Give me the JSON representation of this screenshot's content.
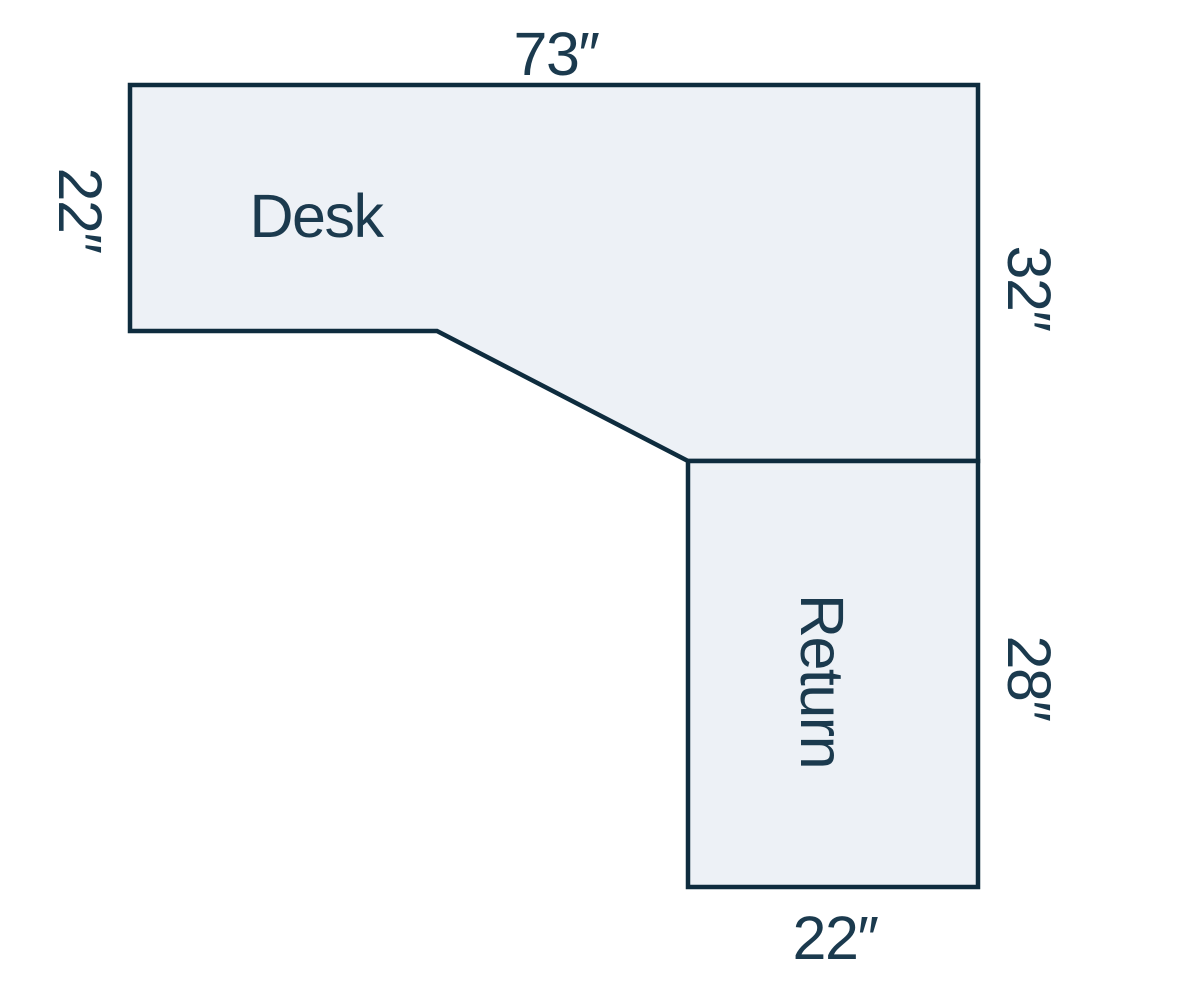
{
  "colors": {
    "background": "#ffffff",
    "shape-fill": "#edf1f6",
    "shape-stroke": "#0e2c3e",
    "label-text": "#1b3a4e"
  },
  "diagram": {
    "desk": {
      "label": "Desk",
      "width_top": "73″",
      "depth_left": "22″",
      "depth_right": "32″"
    },
    "return": {
      "label": "Return",
      "length_right": "28″",
      "width_bottom": "22″"
    }
  }
}
